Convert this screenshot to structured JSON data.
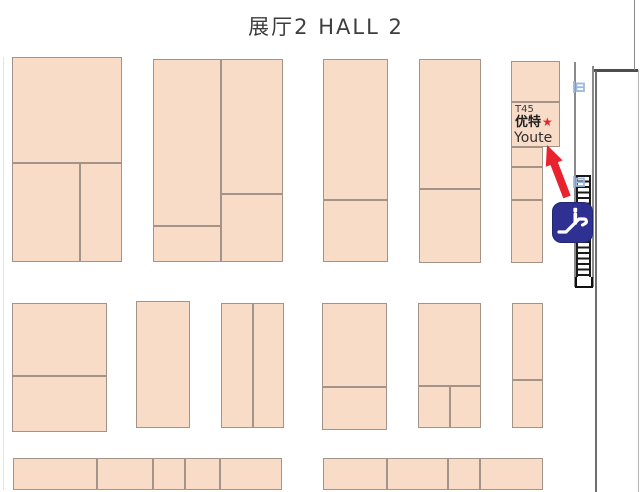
{
  "title": "展厅2 HALL 2",
  "booth": {
    "id": "T45",
    "name_cn": "优特",
    "marker": "★",
    "name_en": "Youte"
  },
  "icons": {
    "escalator": "escalator-icon",
    "door": "door-icon"
  },
  "colors": {
    "booth_fill": "#f9dcc8",
    "booth_border": "#a3948a",
    "highlight_red": "#e8232d",
    "escalator_blue": "#2e3192",
    "wall_dark": "#4d4d4d",
    "door_blue": "#9cb9dc",
    "title_text": "#3d3d3d"
  },
  "map": {
    "cells": [
      [
        12,
        57,
        110,
        106
      ],
      [
        12,
        163,
        68,
        99
      ],
      [
        80,
        163,
        42,
        99
      ],
      [
        153,
        59,
        68,
        167
      ],
      [
        153,
        226,
        68,
        36
      ],
      [
        221,
        59,
        62,
        135
      ],
      [
        221,
        194,
        62,
        68
      ],
      [
        323,
        59,
        65,
        141
      ],
      [
        323,
        200,
        65,
        62
      ],
      [
        419,
        59,
        62,
        130
      ],
      [
        419,
        189,
        62,
        74
      ],
      [
        511,
        61,
        49,
        41
      ],
      [
        511,
        147,
        32,
        20
      ],
      [
        511,
        167,
        32,
        33
      ],
      [
        511,
        200,
        32,
        63
      ],
      [
        12,
        303,
        95,
        73
      ],
      [
        12,
        376,
        95,
        56
      ],
      [
        136,
        301,
        54,
        127
      ],
      [
        221,
        303,
        32,
        125
      ],
      [
        253,
        303,
        31,
        125
      ],
      [
        322,
        303,
        65,
        84
      ],
      [
        322,
        387,
        65,
        43
      ],
      [
        418,
        303,
        63,
        83
      ],
      [
        418,
        386,
        32,
        42
      ],
      [
        450,
        386,
        31,
        42
      ],
      [
        512,
        303,
        31,
        77
      ],
      [
        512,
        380,
        31,
        48
      ],
      [
        13,
        458,
        84,
        32
      ],
      [
        97,
        458,
        56,
        32
      ],
      [
        153,
        458,
        32,
        32
      ],
      [
        185,
        458,
        35,
        32
      ],
      [
        220,
        458,
        62,
        32
      ],
      [
        323,
        458,
        64,
        32
      ],
      [
        387,
        458,
        61,
        32
      ],
      [
        448,
        458,
        32,
        32
      ],
      [
        480,
        458,
        63,
        32
      ]
    ]
  }
}
